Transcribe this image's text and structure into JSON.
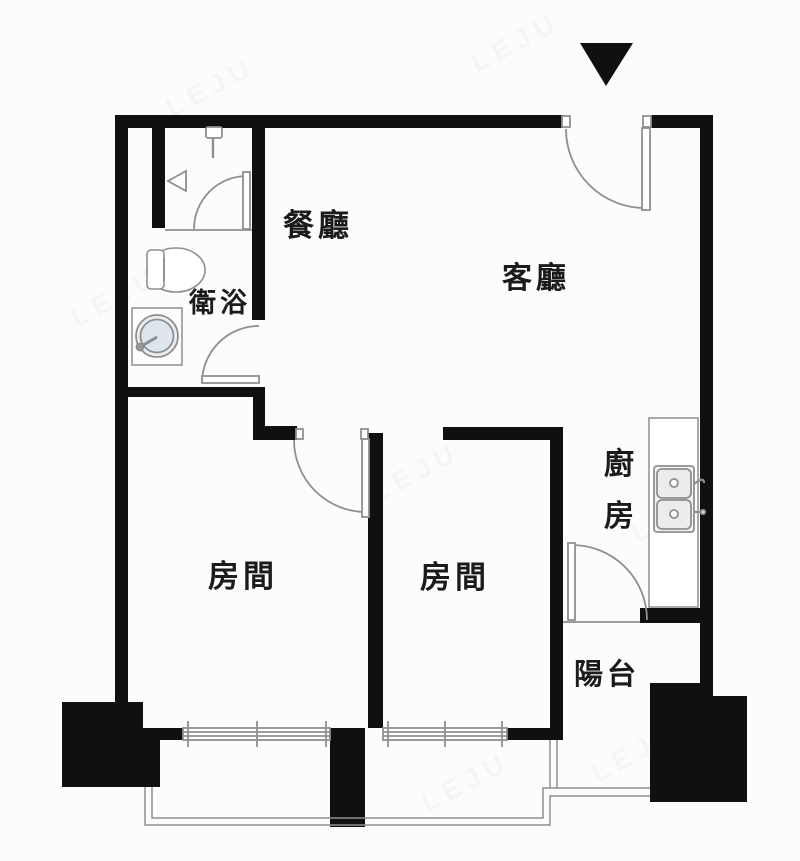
{
  "floorplan": {
    "rooms": {
      "dining": "餐廳",
      "living": "客廳",
      "bathroom": "衛浴",
      "kitchen_char1": "廚",
      "kitchen_char2": "房",
      "bedroom_left": "房間",
      "bedroom_right": "房間",
      "balcony": "陽台"
    },
    "entrance_marker": "entrance-arrow",
    "watermark": "LEJU",
    "colors": {
      "wall": "#101010",
      "thin_line": "#8f8f8f",
      "background": "#fcfcfc",
      "fixture_fill": "#ffffff",
      "sink_water": "#dce6ec"
    }
  }
}
